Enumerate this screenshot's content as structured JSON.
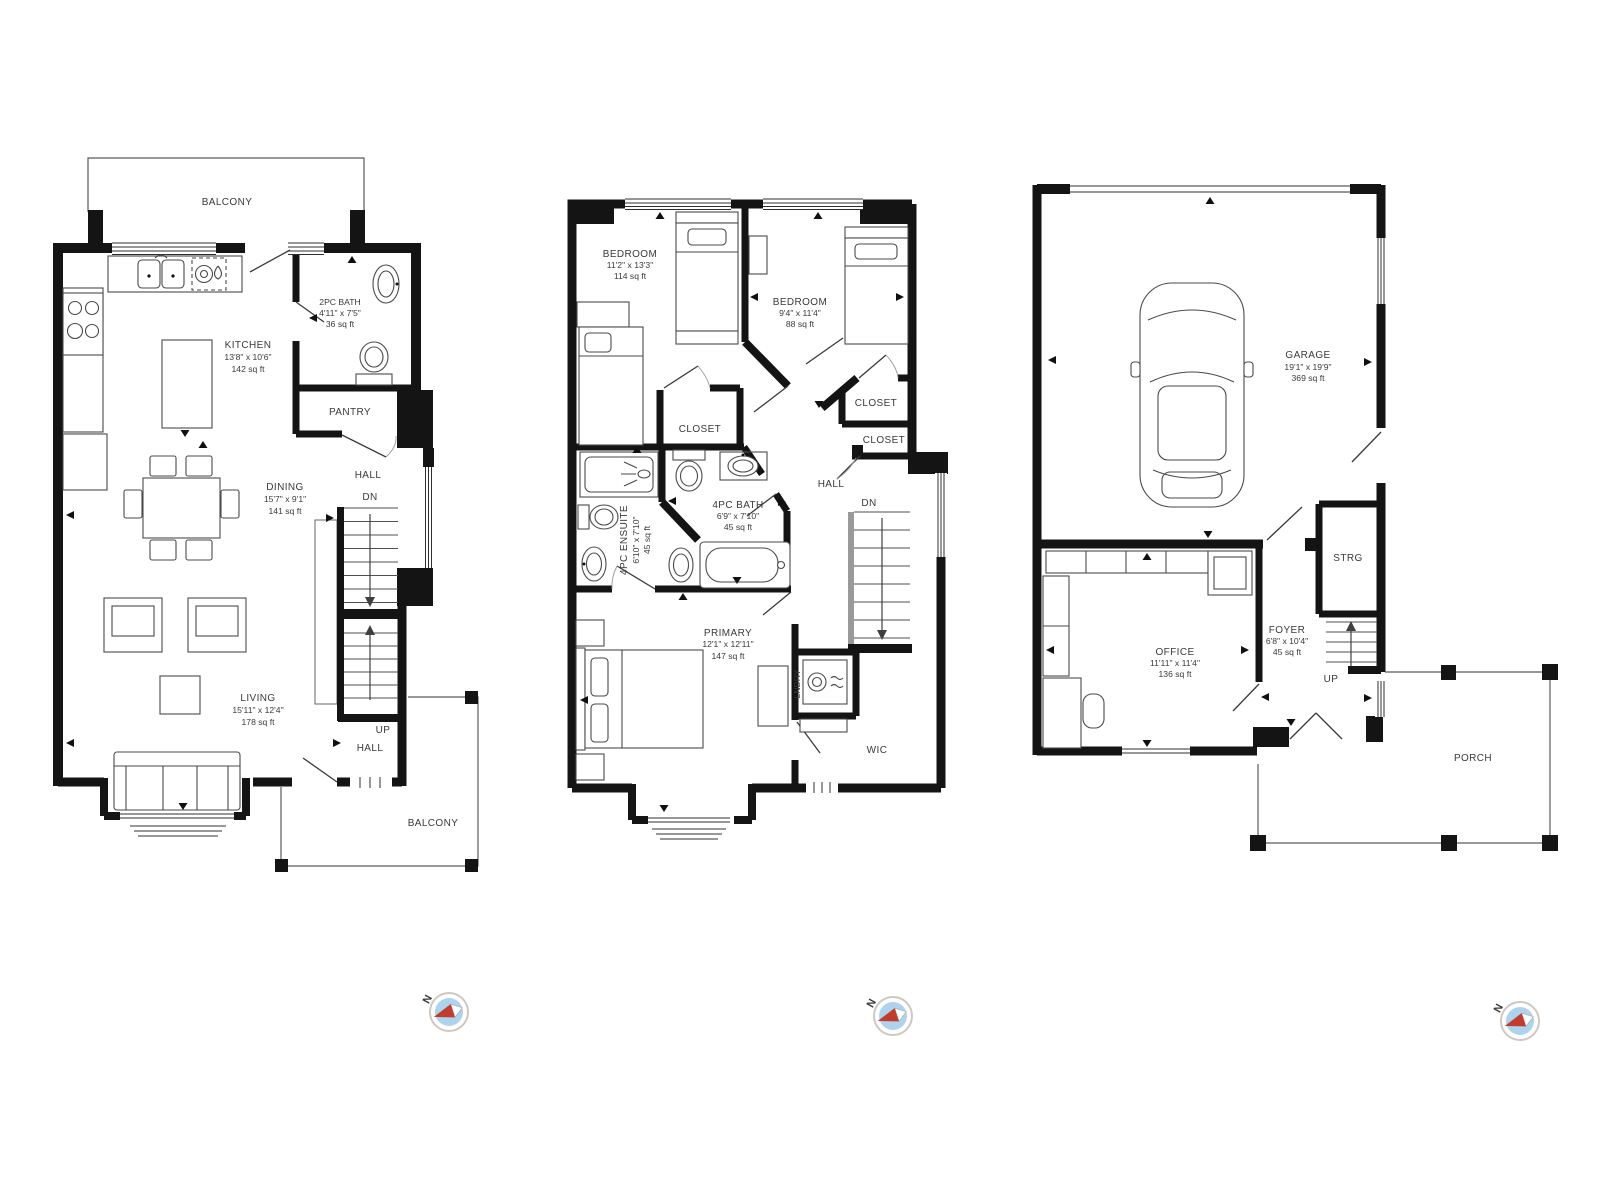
{
  "page": {
    "background": "#ffffff"
  },
  "colors": {
    "wall": "#141414",
    "furniture_line": "#4a4a4a",
    "text": "#3a3a3a",
    "compass_face": "#aed3ec",
    "compass_needle_red": "#c23b2f",
    "compass_needle_white": "#ffffff",
    "compass_ring": "#cfc8c0"
  },
  "compass": {
    "north_label": "N"
  },
  "plans": {
    "main": {
      "rooms": {
        "balcony_top": {
          "name": "BALCONY"
        },
        "bath": {
          "name": "2PC BATH",
          "dims": "4'11\" x 7'5\"",
          "area": "36 sq ft"
        },
        "kitchen": {
          "name": "KITCHEN",
          "dims": "13'8\" x 10'6\"",
          "area": "142 sq ft"
        },
        "pantry": {
          "name": "PANTRY"
        },
        "dining": {
          "name": "DINING",
          "dims": "15'7\" x 9'1\"",
          "area": "141 sq ft"
        },
        "hall_upper": {
          "name": "HALL"
        },
        "stairs_dn": {
          "name": "DN"
        },
        "living": {
          "name": "LIVING",
          "dims": "15'11\" x 12'4\"",
          "area": "178 sq ft"
        },
        "stairs_up": {
          "name": "UP"
        },
        "hall_lower": {
          "name": "HALL"
        },
        "balcony_bottom": {
          "name": "BALCONY"
        }
      }
    },
    "upper": {
      "rooms": {
        "bedroom_left": {
          "name": "BEDROOM",
          "dims": "11'2\" x 13'3\"",
          "area": "114 sq ft"
        },
        "bedroom_right": {
          "name": "BEDROOM",
          "dims": "9'4\" x 11'4\"",
          "area": "88 sq ft"
        },
        "closet_bedroom": {
          "name": "CLOSET"
        },
        "closet_upper": {
          "name": "CLOSET"
        },
        "closet_lower": {
          "name": "CLOSET"
        },
        "bath": {
          "name": "4PC BATH",
          "dims": "6'9\" x 7'10\"",
          "area": "45 sq ft"
        },
        "ensuite": {
          "name": "4PC ENSUITE",
          "dims": "6'10\" x 7'10\"",
          "area": "45 sq ft"
        },
        "hall": {
          "name": "HALL"
        },
        "stairs_dn": {
          "name": "DN"
        },
        "primary": {
          "name": "PRIMARY",
          "dims": "12'1\" x 12'11\"",
          "area": "147 sq ft"
        },
        "laundry": {
          "name": "LNDRY"
        },
        "wic": {
          "name": "WIC"
        }
      }
    },
    "entry": {
      "rooms": {
        "garage": {
          "name": "GARAGE",
          "dims": "19'1\" x 19'9\"",
          "area": "369 sq ft"
        },
        "storage": {
          "name": "STRG"
        },
        "foyer": {
          "name": "FOYER",
          "dims": "6'8\" x 10'4\"",
          "area": "45 sq ft"
        },
        "stairs_up": {
          "name": "UP"
        },
        "office": {
          "name": "OFFICE",
          "dims": "11'11\" x 11'4\"",
          "area": "136 sq ft"
        },
        "porch": {
          "name": "PORCH"
        }
      }
    }
  }
}
